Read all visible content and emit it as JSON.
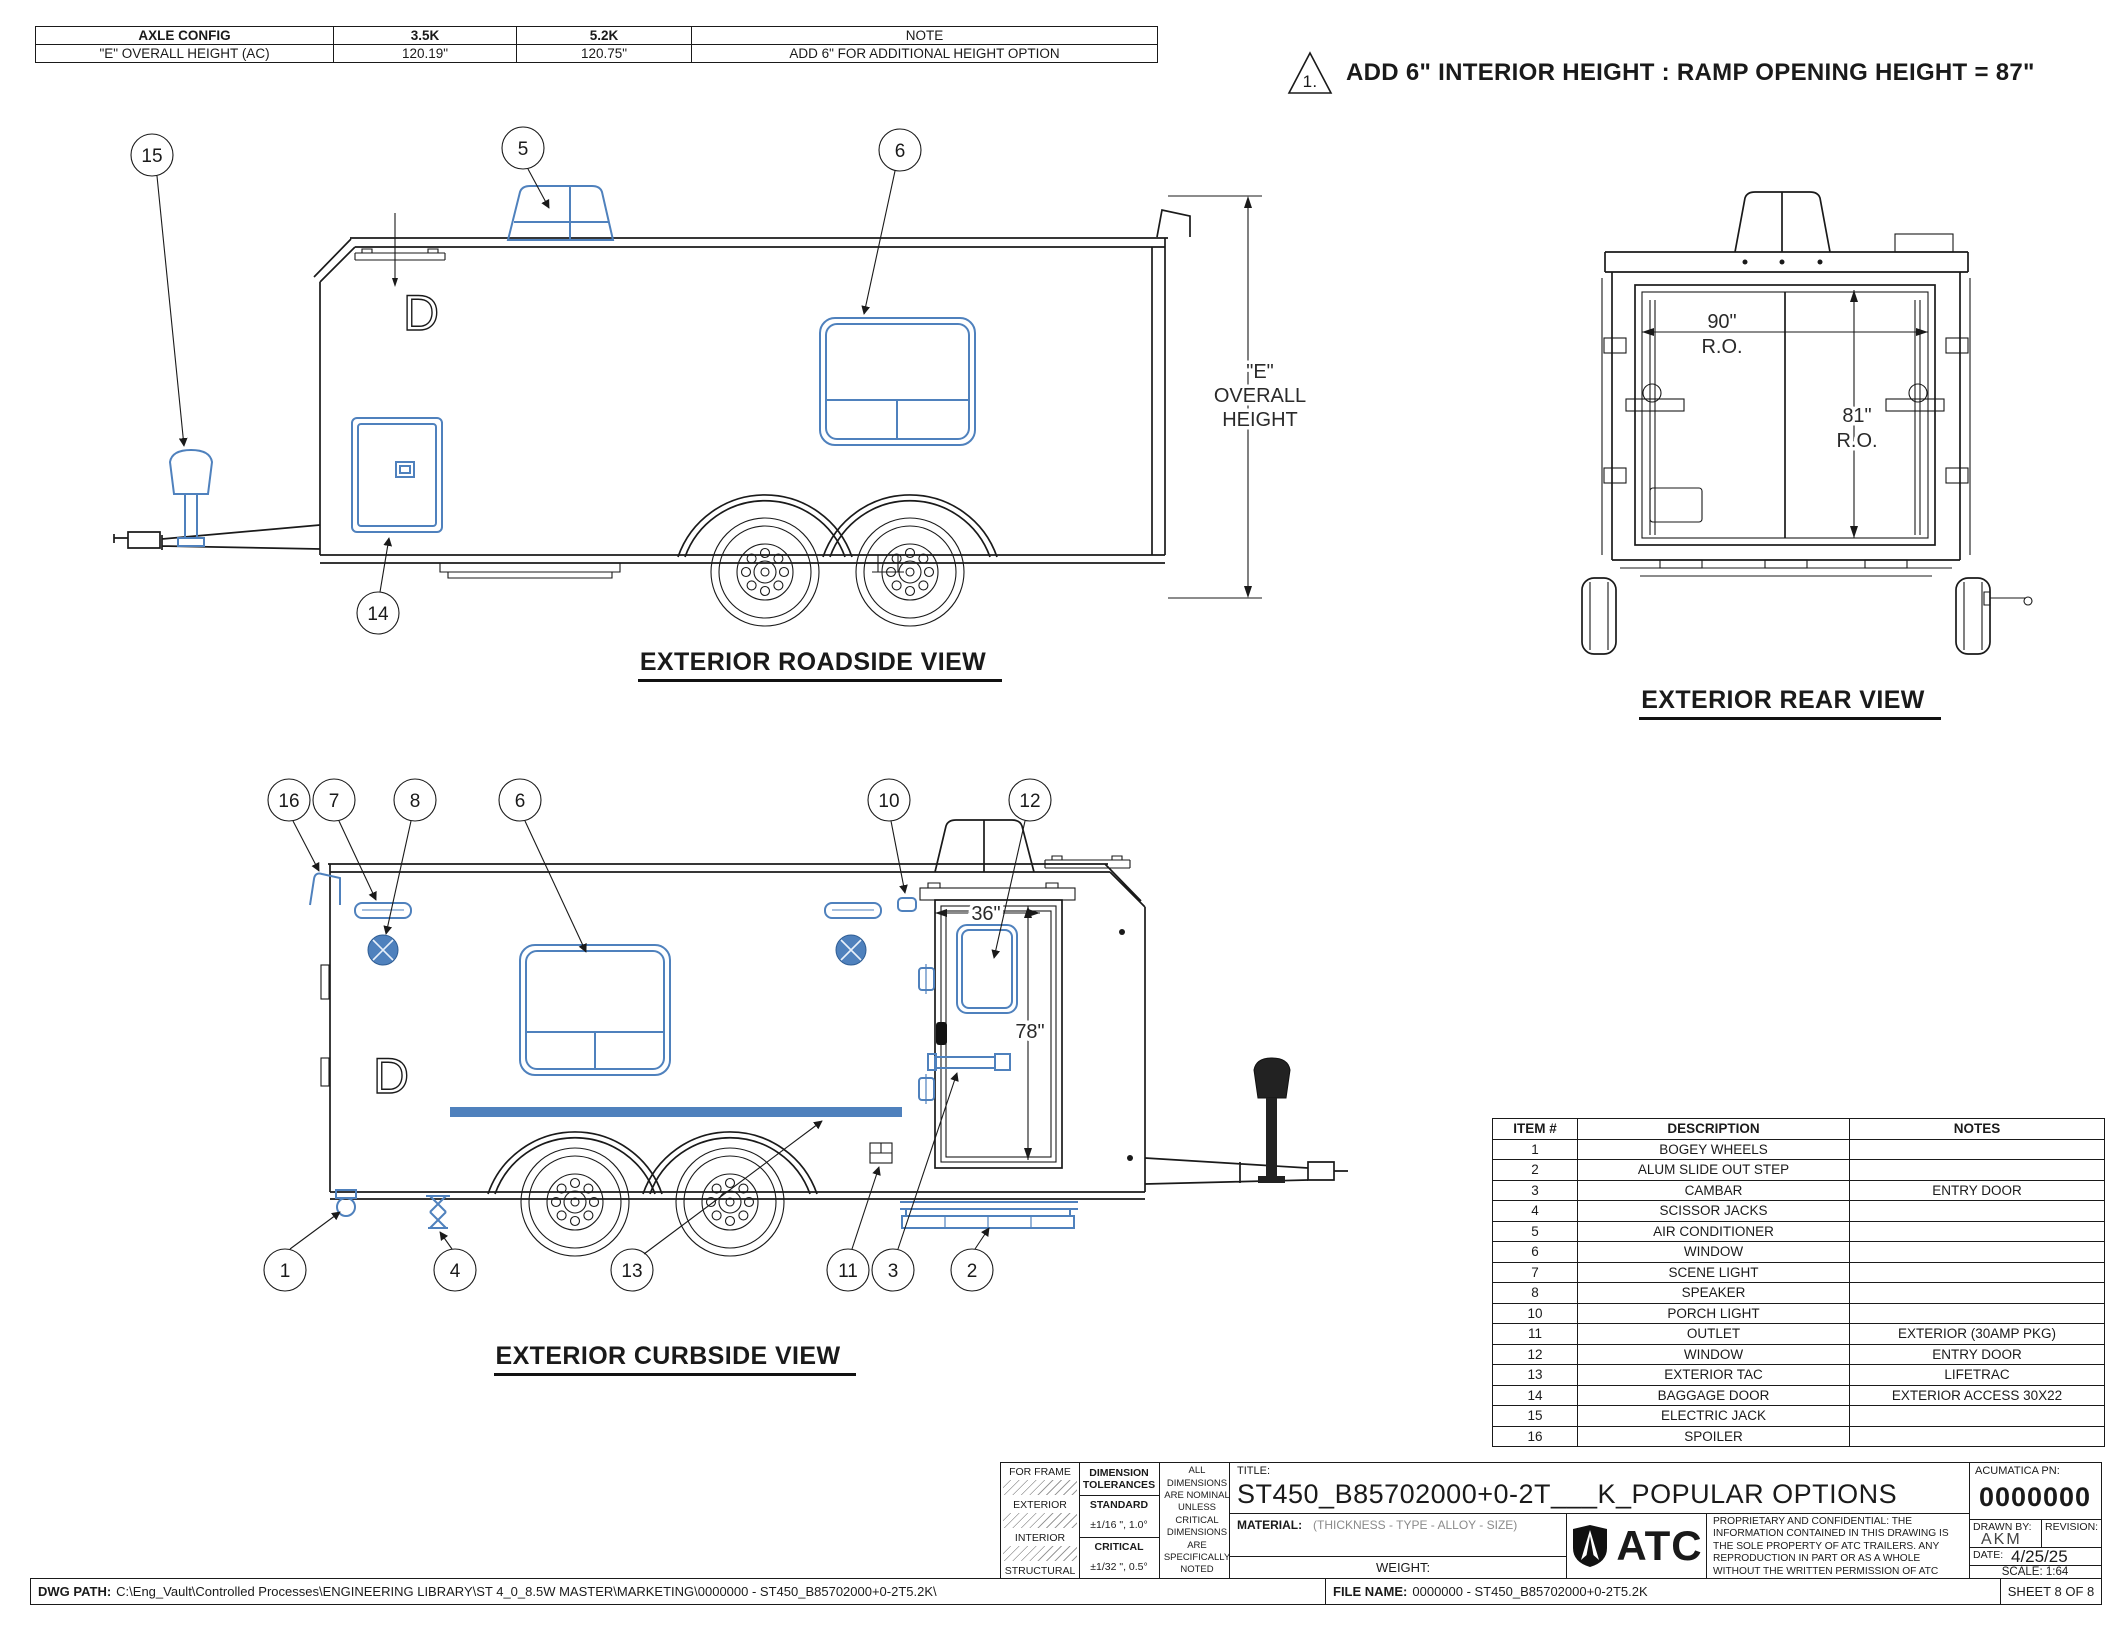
{
  "colors": {
    "accent_blue": "#4f81bd",
    "line_black": "#1a1a1a"
  },
  "header_table": {
    "columns": [
      "AXLE CONFIG",
      "3.5K",
      "5.2K",
      "NOTE"
    ],
    "row": [
      "\"E\" OVERALL HEIGHT (AC)",
      "120.19\"",
      "120.75\"",
      "ADD 6\" FOR ADDITIONAL HEIGHT OPTION"
    ]
  },
  "flag_note": {
    "number": "1.",
    "text": "ADD 6\" INTERIOR HEIGHT : RAMP OPENING HEIGHT = 87\""
  },
  "views": {
    "roadside": {
      "title": "EXTERIOR ROADSIDE VIEW",
      "marking": "D",
      "balloons": {
        "b15": "15",
        "b5": "5",
        "b6": "6",
        "b14": "14"
      },
      "dim_overall": {
        "l1": "\"E\"",
        "l2": "OVERALL",
        "l3": "HEIGHT"
      }
    },
    "rear": {
      "title": "EXTERIOR REAR VIEW",
      "dim_width": {
        "v": "90\"",
        "ro": "R.O."
      },
      "dim_height": {
        "v": "81\"",
        "ro": "R.O."
      }
    },
    "curbside": {
      "title": "EXTERIOR CURBSIDE VIEW",
      "marking": "D",
      "balloons_top": {
        "b16": "16",
        "b7": "7",
        "b8": "8",
        "b6": "6",
        "b10": "10",
        "b12": "12"
      },
      "balloons_bottom": {
        "b1": "1",
        "b4": "4",
        "b13": "13",
        "b11": "11",
        "b3": "3",
        "b2": "2"
      },
      "dim_door_width": "36\"",
      "dim_door_height": "78\""
    }
  },
  "items_table": {
    "headers": [
      "ITEM #",
      "DESCRIPTION",
      "NOTES"
    ],
    "rows": [
      {
        "item": "1",
        "desc": "BOGEY WHEELS",
        "notes": ""
      },
      {
        "item": "2",
        "desc": "ALUM SLIDE OUT STEP",
        "notes": ""
      },
      {
        "item": "3",
        "desc": "CAMBAR",
        "notes": "ENTRY DOOR"
      },
      {
        "item": "4",
        "desc": "SCISSOR JACKS",
        "notes": ""
      },
      {
        "item": "5",
        "desc": "AIR CONDITIONER",
        "notes": ""
      },
      {
        "item": "6",
        "desc": "WINDOW",
        "notes": ""
      },
      {
        "item": "7",
        "desc": "SCENE LIGHT",
        "notes": ""
      },
      {
        "item": "8",
        "desc": "SPEAKER",
        "notes": ""
      },
      {
        "item": "10",
        "desc": "PORCH LIGHT",
        "notes": ""
      },
      {
        "item": "11",
        "desc": "OUTLET",
        "notes": "EXTERIOR (30AMP PKG)"
      },
      {
        "item": "12",
        "desc": "WINDOW",
        "notes": "ENTRY DOOR"
      },
      {
        "item": "13",
        "desc": "EXTERIOR TAC",
        "notes": "LIFETRAC"
      },
      {
        "item": "14",
        "desc": "BAGGAGE DOOR",
        "notes": "EXTERIOR ACCESS 30X22"
      },
      {
        "item": "15",
        "desc": "ELECTRIC JACK",
        "notes": ""
      },
      {
        "item": "16",
        "desc": "SPOILER",
        "notes": ""
      }
    ]
  },
  "title_block": {
    "frame_rows": {
      "r1": "FOR FRAME",
      "r2": "EXTERIOR",
      "r3": "INTERIOR",
      "r4": "STRUCTURAL"
    },
    "tol_header": "DIMENSION TOLERANCES",
    "tol_standard_label": "STANDARD",
    "tol_standard_value": "±1/16 \", 1.0°",
    "tol_critical_label": "CRITICAL",
    "tol_critical_value": "±1/32 \", 0.5°",
    "nominal_note": "ALL DIMENSIONS ARE NOMINAL UNLESS CRITICAL DIMENSIONS ARE SPECIFICALLY NOTED",
    "title_label": "TITLE:",
    "title": "ST450_B85702000+0-2T___K_POPULAR OPTIONS",
    "material_label": "MATERIAL:",
    "material_hint": "(THICKNESS - TYPE - ALLOY - SIZE)",
    "weight_label": "WEIGHT:",
    "logo_text": "ATC",
    "proprietary": "PROPRIETARY AND CONFIDENTIAL: THE INFORMATION CONTAINED IN THIS DRAWING IS THE SOLE PROPERTY OF ATC TRAILERS. ANY REPRODUCTION IN PART OR AS A WHOLE WITHOUT THE WRITTEN PERMISSION OF ATC TRAILERS IS PROHIBITED.",
    "acumatica_label": "ACUMATICA PN:",
    "acumatica_value": "0000000",
    "drawn_by_label": "DRAWN BY:",
    "drawn_by_value": "AKM",
    "revision_label": "REVISION:",
    "date_label": "DATE:",
    "date_value": "4/25/25",
    "scale": "SCALE: 1:64"
  },
  "footer": {
    "dwg_path_label": "DWG PATH:",
    "dwg_path": "C:\\Eng_Vault\\Controlled Processes\\ENGINEERING LIBRARY\\ST 4_0_8.5W MASTER\\MARKETING\\0000000 - ST450_B85702000+0-2T5.2K\\",
    "file_name_label": "FILE NAME:",
    "file_name": "0000000 - ST450_B85702000+0-2T5.2K",
    "sheet": "SHEET 8 OF 8"
  }
}
